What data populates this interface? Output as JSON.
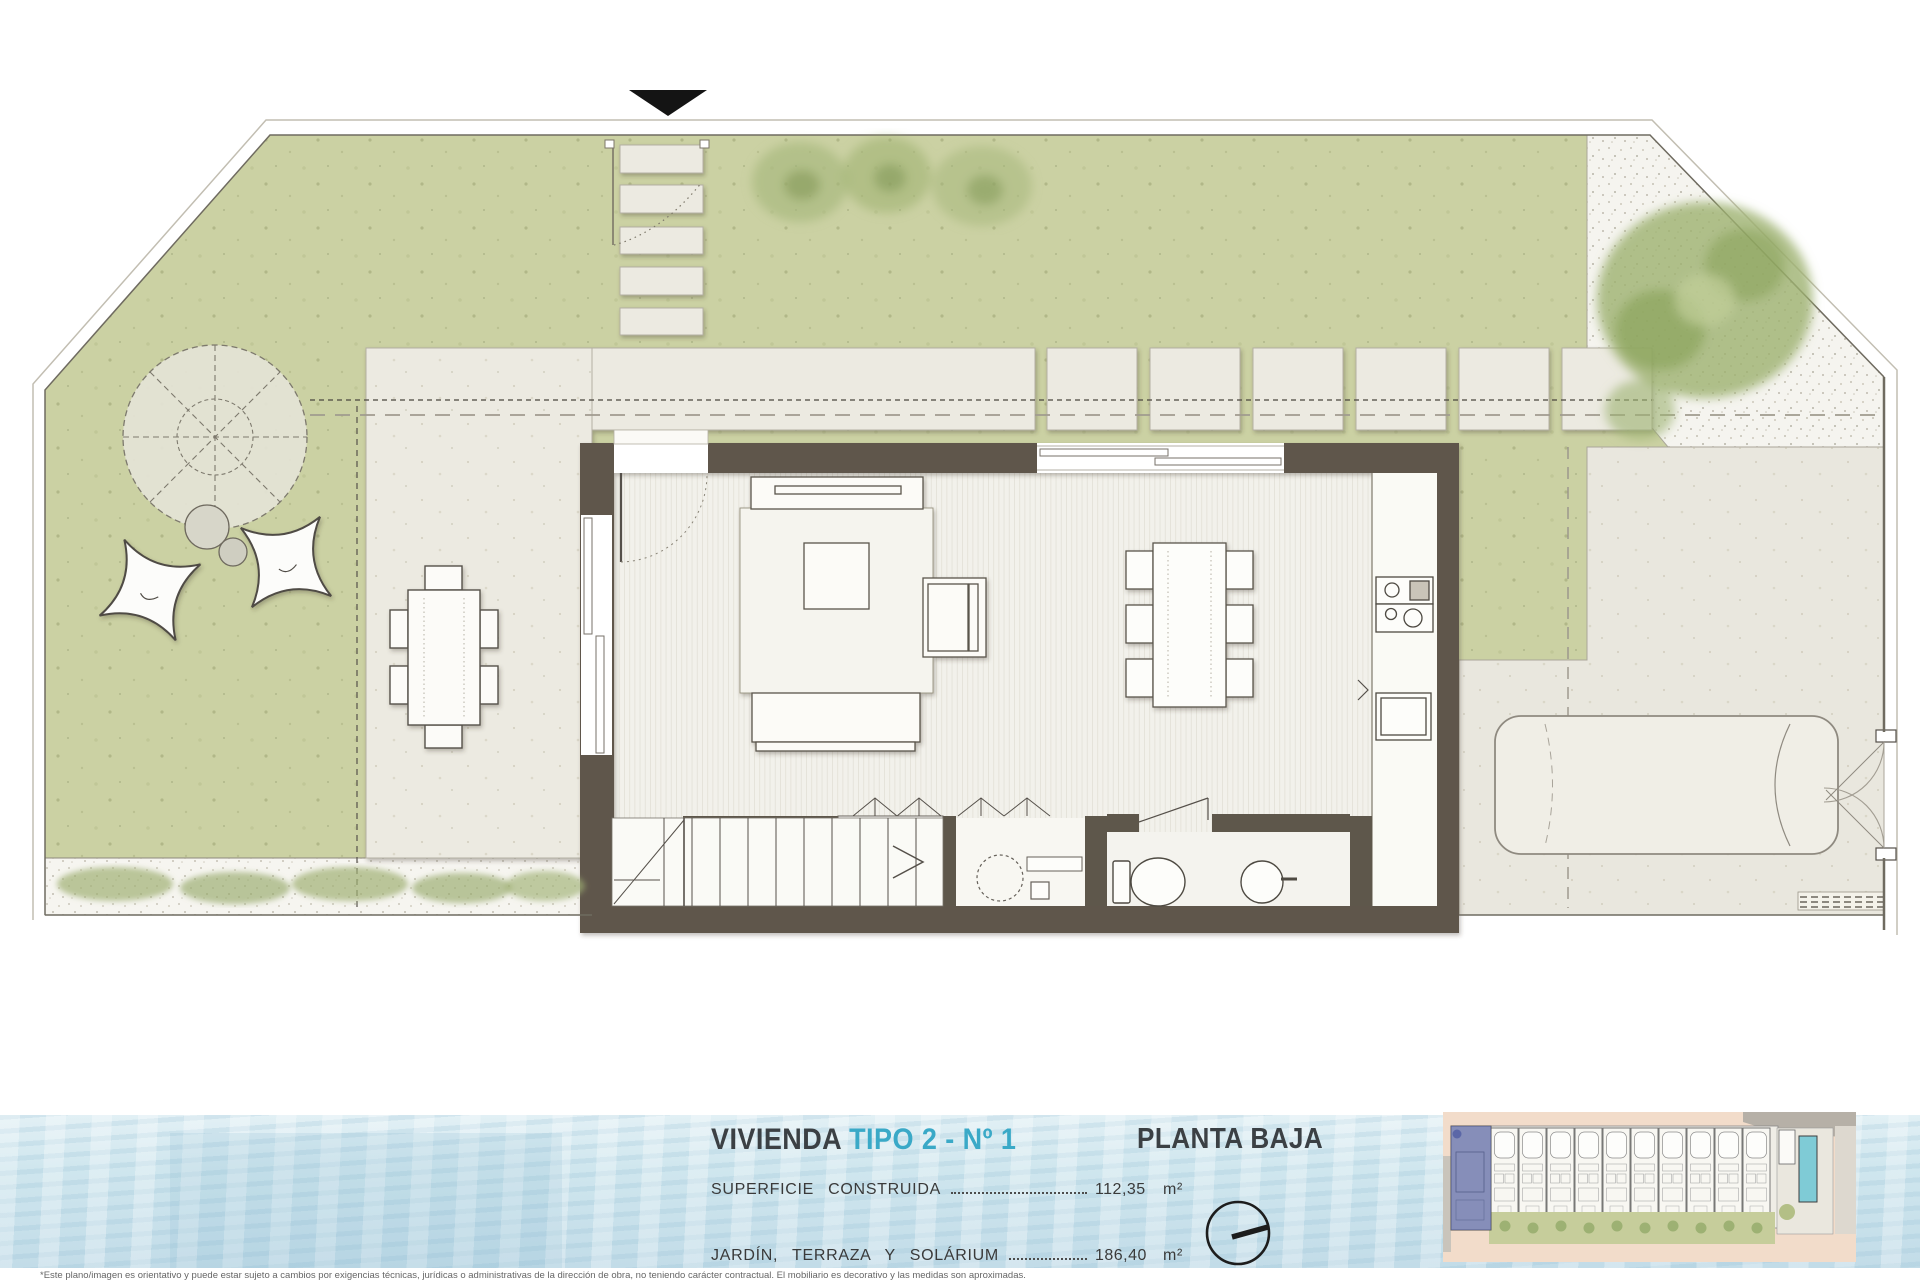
{
  "info_bar": {
    "title_main": "VIVIENDA",
    "title_accent": "TIPO 2 - Nº 1",
    "plan_title": "PLANTA BAJA",
    "rows": [
      {
        "label": "SUPERFICIE CONSTRUIDA",
        "value": "112,35",
        "unit": "m²"
      },
      {
        "label": "JARDÍN, TERRAZA Y SOLÁRIUM",
        "value": "186,40",
        "unit": "m²"
      }
    ],
    "accent_color": "#3aa9c7",
    "text_color": "#3b4044"
  },
  "footnote": "*Este plano/imagen es orientativo y puede estar sujeto a cambios por exigencias técnicas, jurídicas o administrativas de la dirección de obra, no teniendo carácter contractual. El mobiliario es decorativo y las medidas son aproximadas.",
  "icons": {
    "north_indicator": "compass-circle-with-needle",
    "entrance_marker": "solid-down-triangle"
  },
  "site_thumbnail": {
    "description": "site plan of terraced row of houses, first unit highlighted",
    "units_total": 11,
    "highlighted_unit": 1,
    "highlight_color": "#5663a5",
    "pool_color": "#7fcbd6",
    "road_color": "#f2dcca"
  },
  "plan": {
    "type": "architectural-floor-plan",
    "floor_shown": "PLANTA BAJA",
    "colors": {
      "lawn": "#cbd1a3",
      "walls": "#5e574b",
      "paving": "#eceae1",
      "gravel": "#f5f4ef",
      "interior_floor": "#f2f1eb",
      "water": "#cfe6ee"
    },
    "features": [
      "entry-arrow",
      "entry-steps",
      "garden-lawn",
      "pergola-parasol",
      "lounge-chairs",
      "outdoor-dining-set",
      "terrace-paving",
      "stepping-pads",
      "gravel-corner",
      "trees",
      "shrub-border",
      "living-room-sofas",
      "coffee-table",
      "dining-table-six-chairs",
      "kitchen-counter-cooktop",
      "fridge",
      "staircase",
      "utility-room-washer",
      "bathroom-toilet-basin",
      "car-parking-space",
      "driveway-gate"
    ]
  }
}
